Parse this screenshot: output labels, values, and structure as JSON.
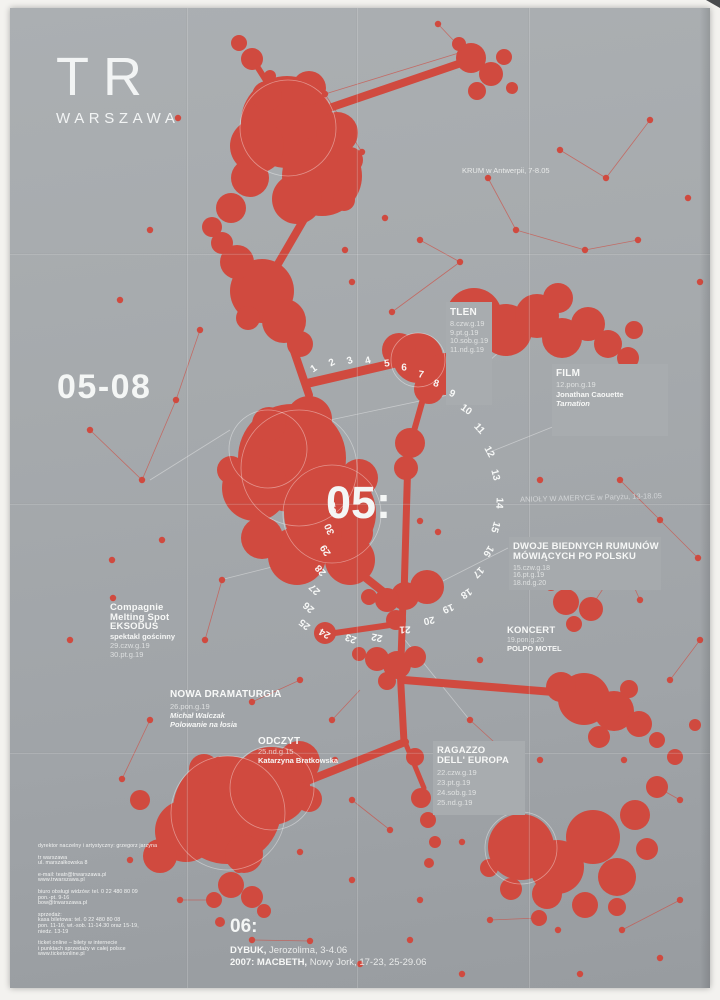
{
  "colors": {
    "background": "#a5a9ac",
    "red": "#d04a3f",
    "text_white": "#f4f6f5"
  },
  "logo": {
    "line1": "TR",
    "line2": "WARSZAWA"
  },
  "season": "05-08",
  "month_may": "05:",
  "calendar": {
    "days": [
      "1",
      "2",
      "3",
      "4",
      "5",
      "6",
      "7",
      "8",
      "9",
      "10",
      "11",
      "12",
      "13",
      "14",
      "15",
      "16",
      "17",
      "18",
      "19",
      "20",
      "21",
      "22",
      "23",
      "24",
      "25",
      "26",
      "27",
      "28",
      "29",
      "30",
      "31"
    ]
  },
  "annotations": {
    "krum": "KRUM w Antwerpii, 7-8.05",
    "anioly": "ANIOŁY W AMERYCE w Paryżu, 13-18.05"
  },
  "events": {
    "tlen": {
      "title": "TLEN",
      "dates": [
        "8.czw.g.19",
        "9.pt.g.19",
        "10.sob.g.19",
        "11.nd.g.19"
      ]
    },
    "film": {
      "title": "FILM",
      "date": "12.pon.g.19",
      "author": "Jonathan Caouette",
      "work": "Tarnation"
    },
    "dwoje": {
      "title1": "DWOJE BIEDNYCH RUMUNÓW",
      "title2": "MÓWIĄCYCH PO POLSKU",
      "dates": [
        "15.czw.g.18",
        "16.pt.g.19",
        "18.nd.g.20"
      ]
    },
    "koncert": {
      "title": "KONCERT",
      "date": "19.pon.g.20",
      "artist": "POLPO MOTEL"
    },
    "eksodus": {
      "company1": "Compagnie",
      "company2": "Melting Spot",
      "title": "EKSODUS",
      "note": "spektakl gościnny",
      "dates": [
        "29.czw.g.19",
        "30.pt.g.19"
      ]
    },
    "nowa_dramaturgia": {
      "title": "NOWA DRAMATURGIA",
      "date": "26.pon.g.19",
      "author": "Michał Walczak",
      "work": "Polowanie na łosia"
    },
    "odczyt": {
      "title": "ODCZYT",
      "date": "25.nd.g.15",
      "author": "Katarzyna Bratkowska"
    },
    "ragazzo": {
      "title1": "RAGAZZO",
      "title2": "DELL' EUROPA",
      "dates": [
        "22.czw.g.19",
        "23.pt.g.19",
        "24.sob.g.19",
        "25.nd.g.19"
      ]
    }
  },
  "june": {
    "heading": "06:",
    "line1_title": "DYBUK,",
    "line1_rest": " Jerozolima, 3-4.06",
    "line2_title": "2007: MACBETH,",
    "line2_rest": " Nowy Jork, 17-23, 25-29.06"
  },
  "contact": {
    "lines": [
      "dyrektor naczelny i artystyczny: grzegorz jarzyna",
      "tr warszawa",
      "ul. marszałkowska 8",
      "e-mail: teatr@trwarszawa.pl",
      "www.trwarszawa.pl",
      "biuro obsługi widzów: tel. 0 22 480 80 09",
      "pon.-pt. 9-16",
      "bow@trwarszawa.pl",
      "sprzedaż:",
      "kasa biletowa: tel. 0 22 480 80 08",
      "pon. 11-16, wt.-sob. 11-14.30 oraz 15-19,",
      "niedz. 13-19",
      "ticket online – bilety w internecie",
      "i punktach sprzedaży w całej polsce",
      "www.ticketonline.pl"
    ]
  }
}
